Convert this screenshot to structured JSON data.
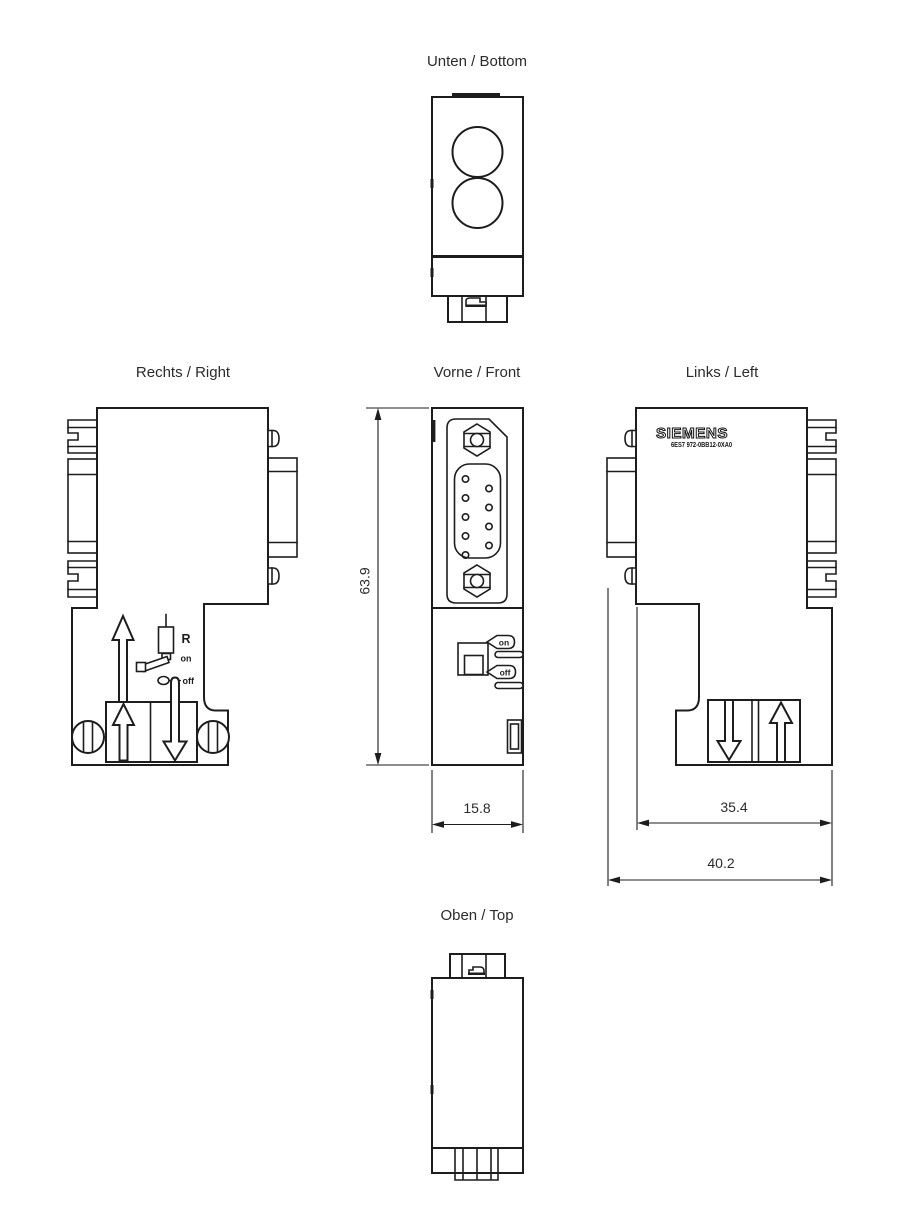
{
  "views": {
    "bottom": {
      "label": "Unten / Bottom"
    },
    "right": {
      "label": "Rechts / Right"
    },
    "front": {
      "label": "Vorne / Front"
    },
    "left": {
      "label": "Links / Left"
    },
    "top": {
      "label": "Oben / Top"
    }
  },
  "branding": {
    "logo": "SIEMENS",
    "part_number": "6ES7 972-0BB12-0XA0"
  },
  "annotations": {
    "resistor_label": "R",
    "right_on": "on",
    "right_off": "off",
    "front_on": "on",
    "front_off": "off"
  },
  "dimensions": {
    "height": "63.9",
    "front_width": "15.8",
    "left_inner_width": "35.4",
    "left_outer_width": "40.2"
  },
  "colors": {
    "line": "#1d1d1d",
    "background": "#ffffff",
    "text": "#2b2b2b"
  }
}
